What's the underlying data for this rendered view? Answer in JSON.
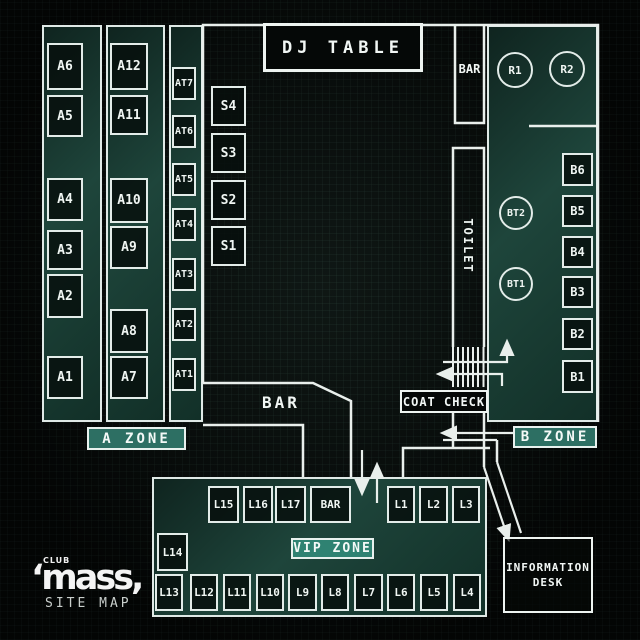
{
  "branding": {
    "club_small": "CLUB",
    "logo_text": "‘mass,",
    "subtitle": "SITE MAP"
  },
  "colors": {
    "background": "#070a09",
    "grid_line": "#344e45",
    "wall": "#e9efec",
    "panel_teal": "#1e453b",
    "zone_label_bg": "#2d6f63",
    "vip_label_bg": "#2f8272",
    "text": "#edf4f1"
  },
  "rooms": {
    "dj_table": "DJ TABLE",
    "top_bar": "BAR",
    "mid_bar": "BAR",
    "toilet": "TOILET",
    "coat_check": "COAT CHECK",
    "info_desk_line1": "INFORMATION",
    "info_desk_line2": "DESK"
  },
  "zone_labels": {
    "a": "A ZONE",
    "b": "B ZONE",
    "vip": "VIP ZONE"
  },
  "seats": {
    "a_left": [
      {
        "id": "A6",
        "x": 47,
        "y": 43,
        "w": 36,
        "h": 47
      },
      {
        "id": "A5",
        "x": 47,
        "y": 95,
        "w": 36,
        "h": 42
      },
      {
        "id": "A4",
        "x": 47,
        "y": 178,
        "w": 36,
        "h": 43
      },
      {
        "id": "A3",
        "x": 47,
        "y": 230,
        "w": 36,
        "h": 40
      },
      {
        "id": "A2",
        "x": 47,
        "y": 274,
        "w": 36,
        "h": 44
      },
      {
        "id": "A1",
        "x": 47,
        "y": 356,
        "w": 36,
        "h": 43
      }
    ],
    "a_mid": [
      {
        "id": "A12",
        "x": 110,
        "y": 43,
        "w": 38,
        "h": 47
      },
      {
        "id": "A11",
        "x": 110,
        "y": 95,
        "w": 38,
        "h": 40
      },
      {
        "id": "A10",
        "x": 110,
        "y": 178,
        "w": 38,
        "h": 45
      },
      {
        "id": "A9",
        "x": 110,
        "y": 226,
        "w": 38,
        "h": 43
      },
      {
        "id": "A8",
        "x": 110,
        "y": 309,
        "w": 38,
        "h": 44
      },
      {
        "id": "A7",
        "x": 110,
        "y": 356,
        "w": 38,
        "h": 43
      }
    ],
    "at": [
      {
        "id": "AT7",
        "x": 172,
        "y": 67,
        "w": 24,
        "h": 33
      },
      {
        "id": "AT6",
        "x": 172,
        "y": 115,
        "w": 24,
        "h": 33
      },
      {
        "id": "AT5",
        "x": 172,
        "y": 163,
        "w": 24,
        "h": 33
      },
      {
        "id": "AT4",
        "x": 172,
        "y": 208,
        "w": 24,
        "h": 33
      },
      {
        "id": "AT3",
        "x": 172,
        "y": 258,
        "w": 24,
        "h": 33
      },
      {
        "id": "AT2",
        "x": 172,
        "y": 308,
        "w": 24,
        "h": 33
      },
      {
        "id": "AT1",
        "x": 172,
        "y": 358,
        "w": 24,
        "h": 33
      }
    ],
    "s": [
      {
        "id": "S4",
        "x": 211,
        "y": 86,
        "w": 35,
        "h": 40
      },
      {
        "id": "S3",
        "x": 211,
        "y": 133,
        "w": 35,
        "h": 40
      },
      {
        "id": "S2",
        "x": 211,
        "y": 180,
        "w": 35,
        "h": 40
      },
      {
        "id": "S1",
        "x": 211,
        "y": 226,
        "w": 35,
        "h": 40
      }
    ],
    "b": [
      {
        "id": "B6",
        "x": 562,
        "y": 153,
        "w": 31,
        "h": 33
      },
      {
        "id": "B5",
        "x": 562,
        "y": 195,
        "w": 31,
        "h": 32
      },
      {
        "id": "B4",
        "x": 562,
        "y": 236,
        "w": 31,
        "h": 32
      },
      {
        "id": "B3",
        "x": 562,
        "y": 276,
        "w": 31,
        "h": 32
      },
      {
        "id": "B2",
        "x": 562,
        "y": 318,
        "w": 31,
        "h": 32
      },
      {
        "id": "B1",
        "x": 562,
        "y": 360,
        "w": 31,
        "h": 33
      }
    ],
    "vip_top": [
      {
        "id": "L15",
        "x": 208,
        "y": 486,
        "w": 31,
        "h": 37
      },
      {
        "id": "L16",
        "x": 243,
        "y": 486,
        "w": 30,
        "h": 37
      },
      {
        "id": "L17",
        "x": 275,
        "y": 486,
        "w": 31,
        "h": 37
      },
      {
        "id": "BAR",
        "x": 310,
        "y": 486,
        "w": 41,
        "h": 37
      },
      {
        "id": "L1",
        "x": 387,
        "y": 486,
        "w": 28,
        "h": 37
      },
      {
        "id": "L2",
        "x": 419,
        "y": 486,
        "w": 29,
        "h": 37
      },
      {
        "id": "L3",
        "x": 452,
        "y": 486,
        "w": 28,
        "h": 37
      }
    ],
    "vip_mid": [
      {
        "id": "L14",
        "x": 157,
        "y": 533,
        "w": 31,
        "h": 38
      }
    ],
    "vip_bottom": [
      {
        "id": "L13",
        "x": 155,
        "y": 574,
        "w": 28,
        "h": 37
      },
      {
        "id": "L12",
        "x": 190,
        "y": 574,
        "w": 28,
        "h": 37
      },
      {
        "id": "L11",
        "x": 223,
        "y": 574,
        "w": 28,
        "h": 37
      },
      {
        "id": "L10",
        "x": 256,
        "y": 574,
        "w": 28,
        "h": 37
      },
      {
        "id": "L9",
        "x": 288,
        "y": 574,
        "w": 29,
        "h": 37
      },
      {
        "id": "L8",
        "x": 321,
        "y": 574,
        "w": 28,
        "h": 37
      },
      {
        "id": "L7",
        "x": 354,
        "y": 574,
        "w": 29,
        "h": 37
      },
      {
        "id": "L6",
        "x": 387,
        "y": 574,
        "w": 28,
        "h": 37
      },
      {
        "id": "L5",
        "x": 420,
        "y": 574,
        "w": 28,
        "h": 37
      },
      {
        "id": "L4",
        "x": 453,
        "y": 574,
        "w": 28,
        "h": 37
      }
    ],
    "circles": [
      {
        "id": "R1",
        "cx": 515,
        "cy": 70,
        "r": 18
      },
      {
        "id": "R2",
        "cx": 567,
        "cy": 69,
        "r": 18
      },
      {
        "id": "BT2",
        "cx": 516,
        "cy": 213,
        "r": 17
      },
      {
        "id": "BT1",
        "cx": 516,
        "cy": 284,
        "r": 17
      }
    ]
  }
}
